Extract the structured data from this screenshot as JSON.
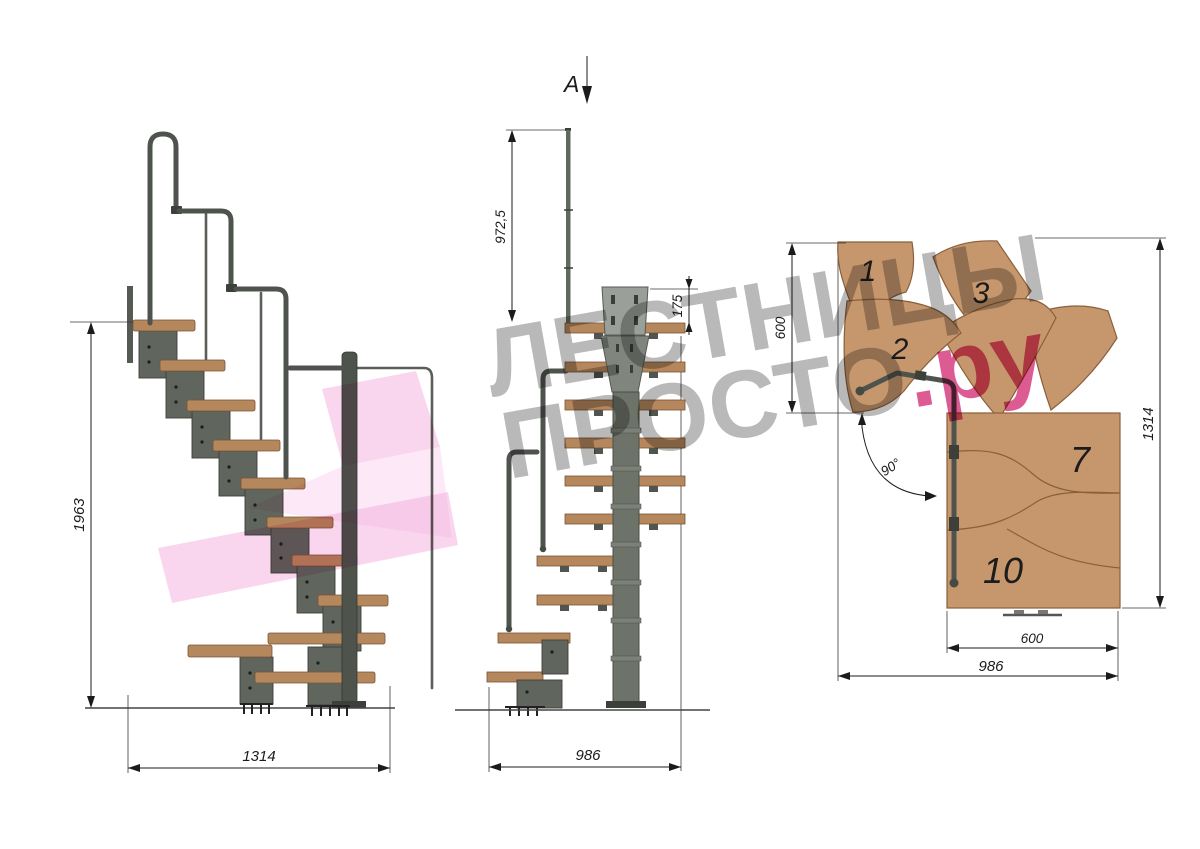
{
  "title": "Modular staircase technical drawing, 90-degree turn",
  "side_view": {
    "height_label": "1963",
    "width_label": "1314"
  },
  "front_view": {
    "section_label": "А",
    "rail_height_label": "972,5",
    "plate_height_label": "175",
    "width_label": "986"
  },
  "plan_view": {
    "landing_depth_label": "600",
    "total_depth_label": "1314",
    "angle_label": "90°",
    "flight_width_label": "600",
    "total_width_label": "986",
    "tread_numbers": {
      "t1": "1",
      "t2": "2",
      "t3": "3",
      "t7": "7",
      "t10": "10"
    }
  },
  "watermark": {
    "line1": "ЛЕСТНИЦЫ",
    "line2_gray": "ПРОСТО",
    "line2_pink": ".ру"
  },
  "colors": {
    "wood": "#c6976d",
    "wood_edge": "#8a5f3a",
    "tread_side": "#b5875c",
    "metal": "#60655d",
    "metal_dark": "#3c403a",
    "column": "#6e7369",
    "plate": "#9aa099",
    "rail": "#4e534d",
    "dim": "#1b1b1b",
    "watermark_gray": "#8f8f8f",
    "watermark_pink": "#d2327a",
    "arrow_pink": "#f3aede"
  }
}
